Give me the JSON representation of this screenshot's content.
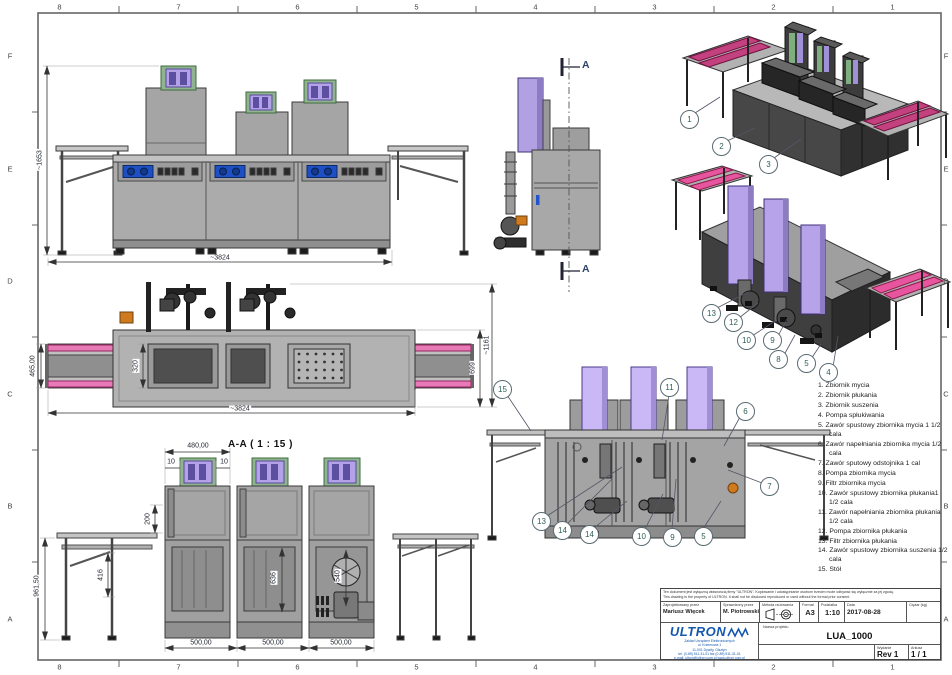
{
  "frame": {
    "cols": [
      "8",
      "7",
      "6",
      "5",
      "4",
      "3",
      "2",
      "1"
    ],
    "rows": [
      "F",
      "E",
      "D",
      "C",
      "B",
      "A"
    ]
  },
  "annotations": {
    "section_label": "A-A ( 1 : 15 )",
    "section_marker_top": "A",
    "section_marker_bottom": "A"
  },
  "dimensions": [
    {
      "text": "~1653",
      "x": 40,
      "y": 160,
      "rot": -90
    },
    {
      "text": "~3824",
      "x": 220,
      "y": 258,
      "rot": 0
    },
    {
      "text": "465,00",
      "x": 33,
      "y": 366,
      "rot": -90
    },
    {
      "text": "320",
      "x": 136,
      "y": 366,
      "rot": -90
    },
    {
      "text": "699",
      "x": 473,
      "y": 368,
      "rot": -90
    },
    {
      "text": "~1161",
      "x": 487,
      "y": 345,
      "rot": -90
    },
    {
      "text": "~3824",
      "x": 240,
      "y": 409,
      "rot": 0
    },
    {
      "text": "480,00",
      "x": 198,
      "y": 446,
      "rot": 0
    },
    {
      "text": "10",
      "x": 171,
      "y": 462,
      "rot": 0
    },
    {
      "text": "10",
      "x": 224,
      "y": 462,
      "rot": 0
    },
    {
      "text": "200",
      "x": 148,
      "y": 519,
      "rot": -90
    },
    {
      "text": "416",
      "x": 101,
      "y": 575,
      "rot": -90
    },
    {
      "text": "961,50",
      "x": 37,
      "y": 586,
      "rot": -90
    },
    {
      "text": "636",
      "x": 274,
      "y": 578,
      "rot": -90
    },
    {
      "text": "540",
      "x": 338,
      "y": 576,
      "rot": -90
    },
    {
      "text": "500,00",
      "x": 201,
      "y": 643,
      "rot": 0
    },
    {
      "text": "500,00",
      "x": 273,
      "y": 643,
      "rot": 0
    },
    {
      "text": "500,00",
      "x": 341,
      "y": 643,
      "rot": 0
    }
  ],
  "balloons": [
    {
      "n": "1",
      "x": 689,
      "y": 119
    },
    {
      "n": "2",
      "x": 721,
      "y": 146
    },
    {
      "n": "3",
      "x": 768,
      "y": 164
    },
    {
      "n": "13",
      "x": 711,
      "y": 313
    },
    {
      "n": "12",
      "x": 733,
      "y": 322
    },
    {
      "n": "10",
      "x": 746,
      "y": 340
    },
    {
      "n": "9",
      "x": 772,
      "y": 340
    },
    {
      "n": "8",
      "x": 778,
      "y": 359
    },
    {
      "n": "5",
      "x": 806,
      "y": 363
    },
    {
      "n": "4",
      "x": 828,
      "y": 372
    },
    {
      "n": "15",
      "x": 502,
      "y": 389
    },
    {
      "n": "11",
      "x": 669,
      "y": 387
    },
    {
      "n": "6",
      "x": 745,
      "y": 411
    },
    {
      "n": "7",
      "x": 769,
      "y": 486
    },
    {
      "n": "13",
      "x": 541,
      "y": 521
    },
    {
      "n": "14",
      "x": 562,
      "y": 530
    },
    {
      "n": "14",
      "x": 589,
      "y": 534
    },
    {
      "n": "10",
      "x": 641,
      "y": 536
    },
    {
      "n": "9",
      "x": 672,
      "y": 537
    },
    {
      "n": "5",
      "x": 703,
      "y": 536
    }
  ],
  "parts_list": [
    "1. Zbiornik mycia",
    "2. Zbiornik płukania",
    "3. Zbiornik suszenia",
    "4. Pompa spłukiwania",
    "5. Zawór spustowy zbiornika mycia 1 1/2 cala",
    "6. Zawór napełniania zbiornika mycia 1/2 cala",
    "7. Zawór sputowy odstojnika 1 cal",
    "8. Pompa zbiornika mycia",
    "9. Filtr zbiornika mycia",
    "10. Zawór spustowy zbiornika płukania1 1/2 cala",
    "11. Zawór napełniania zbiornika płukania 1/2 cala",
    "12. Pompa zbiornika płukania",
    "13. Filtr zbiornika płukania",
    "14. Zawór spustowy zbiornika suszenia 1/2 cala",
    "15. Stół"
  ],
  "title_block": {
    "disclaimer_pl": "Ten dokument jest wyłączną własnością firmy \"ULTRON\". Kopiowanie i udostępnianie osobom trzecim może odbywać się wyłącznie za jej zgodą.",
    "disclaimer_en": "This drawing is the property of ULTRON. It shall not be disclosed reproduced or used without the formal prior consent.",
    "designed_label": "Zaprojektowany przez",
    "designed_value": "Mariusz Więcek",
    "checked_label": "Sprawdzony przez",
    "checked_value": "M. Piotrowski",
    "projection_label": "Metoda rzutowania",
    "format_label": "Format",
    "format_value": "A3",
    "scale_label": "Podziałka",
    "scale_value": "1:10",
    "date_label": "Data",
    "date_value": "2017-08-28",
    "weight_label": "Ciężar (kg)",
    "project_label": "Nazwa projektu",
    "project_value": "LUA_1000",
    "edition_label": "Wydanie",
    "edition_value": "Rev 1",
    "sheet_label": "Arkusz",
    "sheet_value": "1 / 1",
    "company": {
      "name": "ULTRON",
      "line1": "Zakład Urządzeń Elektronicznych",
      "line2": "ul. Krzemowa 1",
      "line3": "11-001 Dywity, Olsztyn",
      "line4": "tel. (0-89) 511-31-01   fax (0-89) 511-31-01",
      "line5": "e-mail: ultron@ultron.com.pl    www.ultron.com.pl"
    }
  },
  "colors": {
    "logo_blue": "#1558b0",
    "hood_purple": "#b7a3ea",
    "conveyor_pink": "#e8559f",
    "valve_orange": "#d07a1e",
    "display_blue": "#1e4fc4"
  }
}
